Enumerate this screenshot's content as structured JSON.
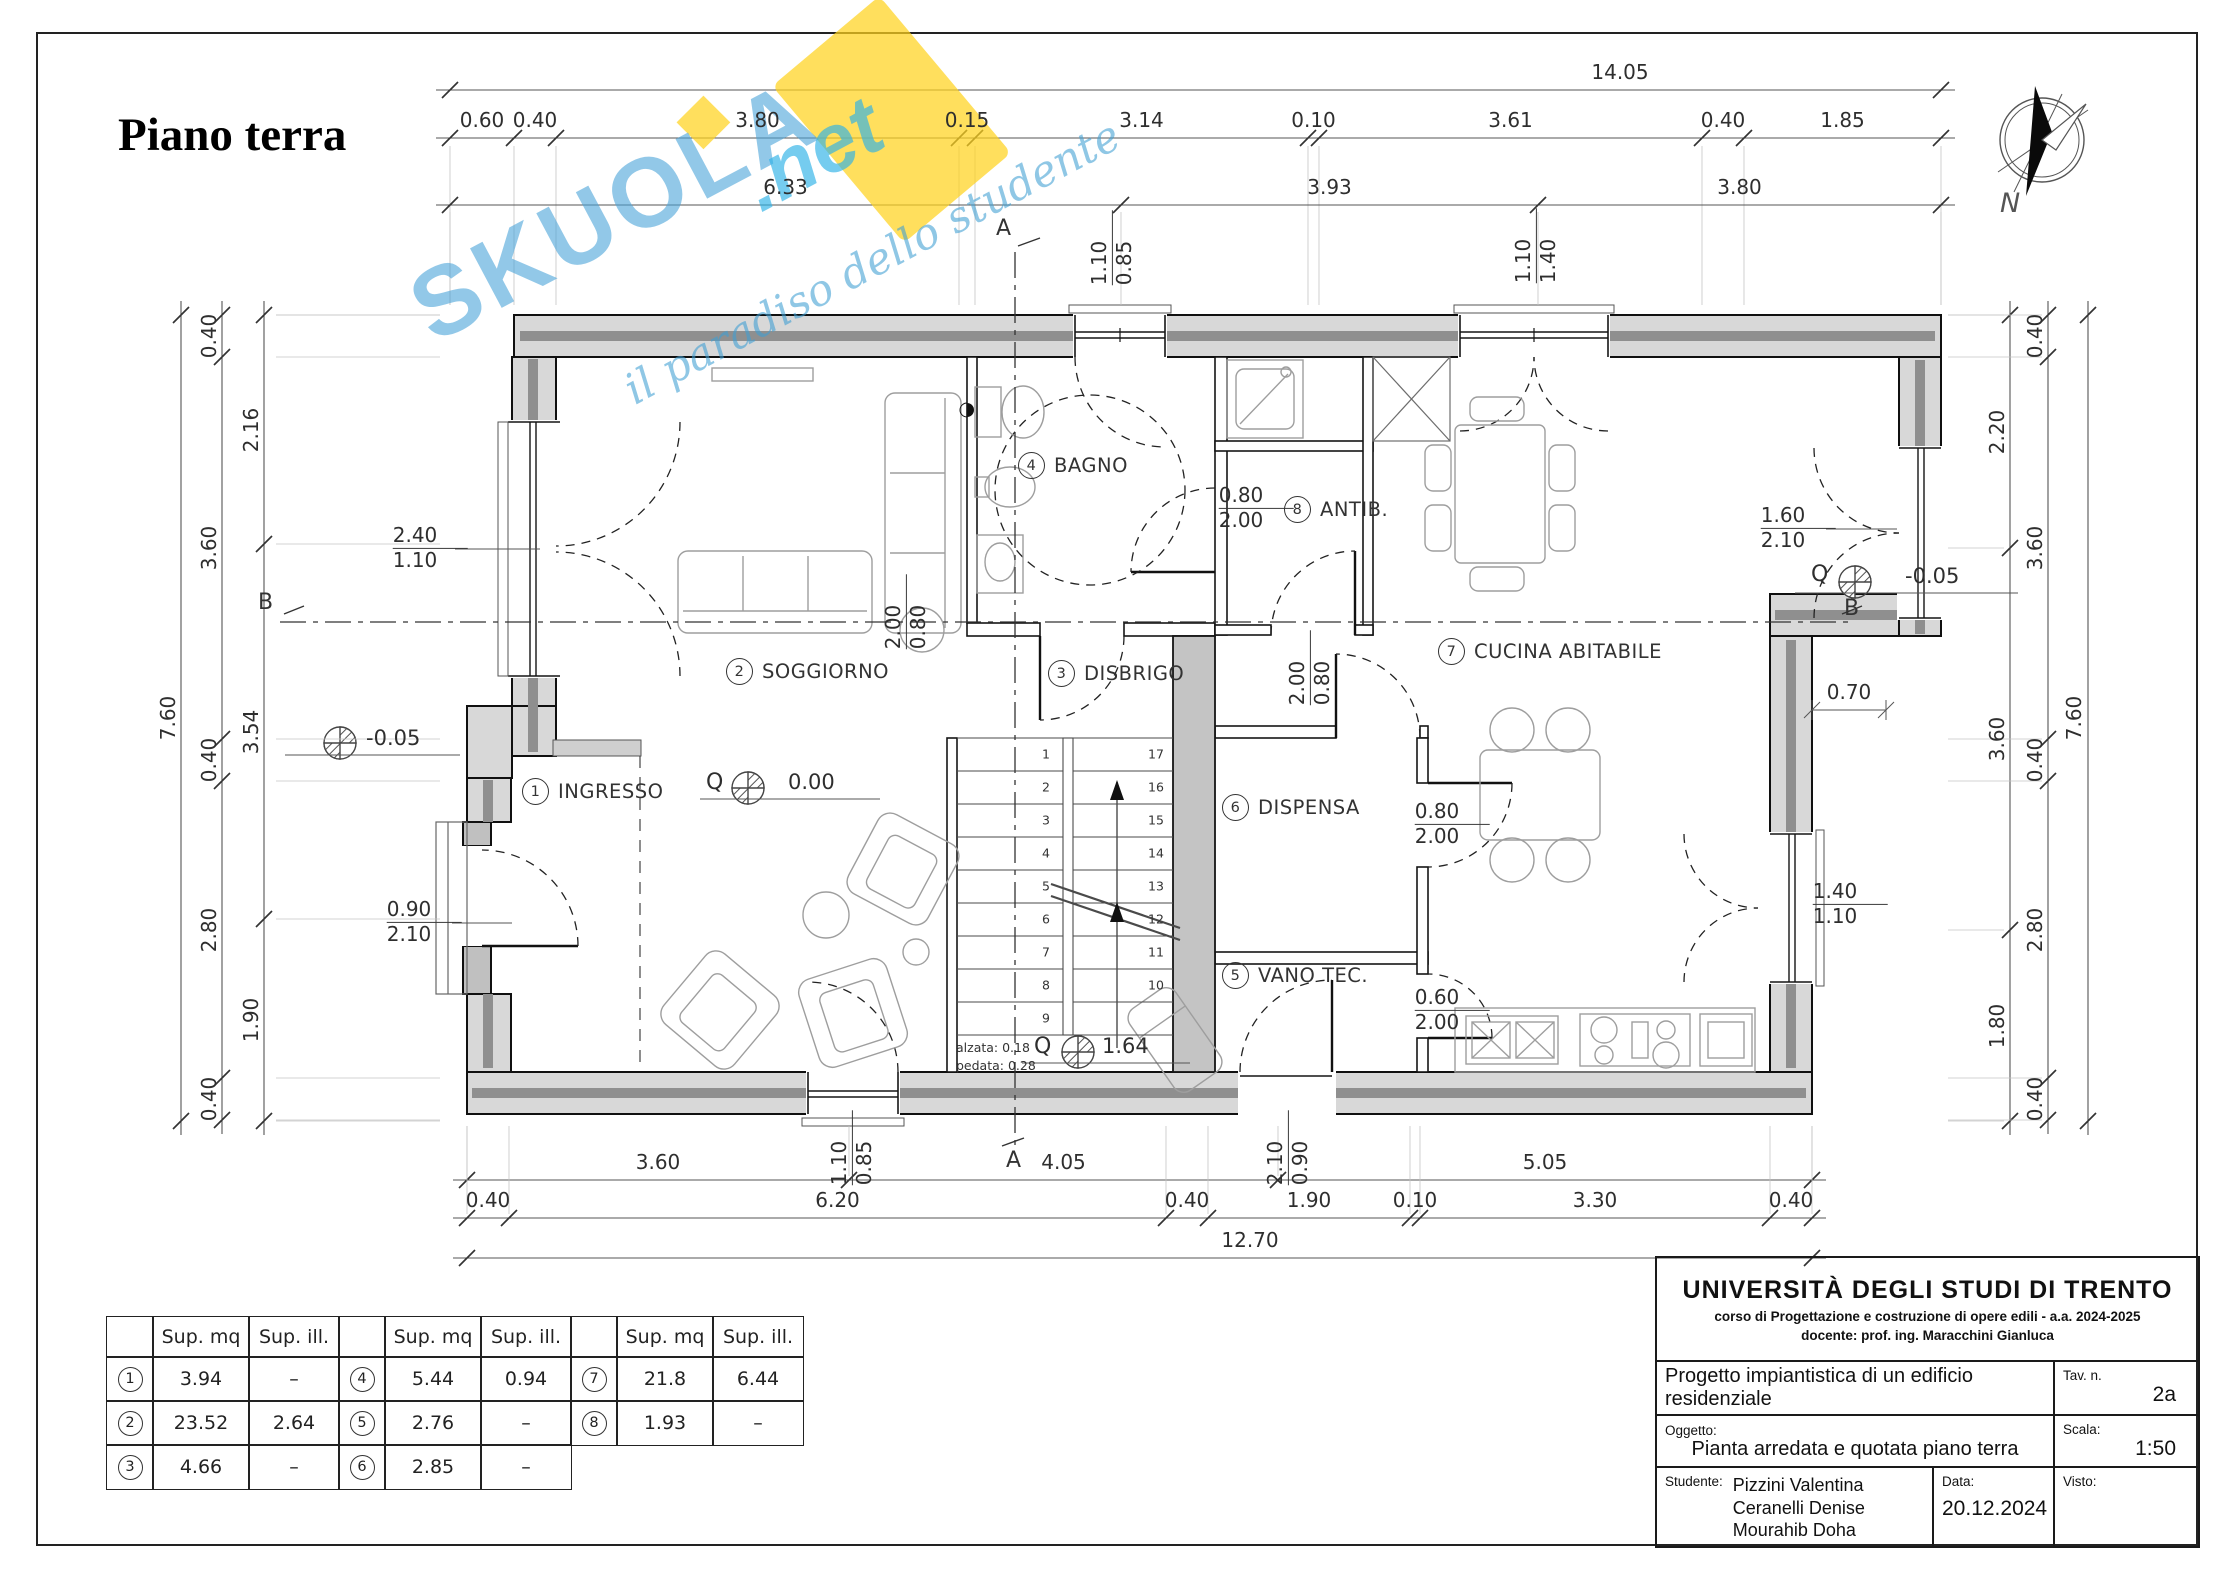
{
  "sheet": {
    "title": "Piano terra",
    "compass": "N"
  },
  "watermark": {
    "brand": "SKUOLA",
    "suffix": ".net",
    "tagline": "il paradiso dello studente"
  },
  "sections": {
    "a": "A",
    "b": "B"
  },
  "quotas": {
    "prefix": "Q",
    "left": "-0.05",
    "living": "0.00",
    "right": "-0.05"
  },
  "stairs": {
    "left_steps": [
      "1",
      "2",
      "3",
      "4",
      "5",
      "6",
      "7",
      "8",
      "9"
    ],
    "right_steps": [
      "17",
      "16",
      "15",
      "14",
      "13",
      "12",
      "11",
      "10"
    ],
    "riser_note": "alzata: 0.18",
    "tread_note": "pedata: 0.28",
    "quota_prefix": "Q",
    "mid_quota": "1.64"
  },
  "rooms": [
    {
      "num": "1",
      "name": "INGRESSO"
    },
    {
      "num": "2",
      "name": "SOGGIORNO"
    },
    {
      "num": "3",
      "name": "DISBRIGO"
    },
    {
      "num": "4",
      "name": "BAGNO"
    },
    {
      "num": "5",
      "name": "VANO  TEC."
    },
    {
      "num": "6",
      "name": "DISPENSA"
    },
    {
      "num": "7",
      "name": "CUCINA  ABITABILE"
    },
    {
      "num": "8",
      "name": "ANTIB."
    }
  ],
  "openings": {
    "left_window": [
      "2.40",
      "1.10"
    ],
    "entry_door": [
      "0.90",
      "2.10"
    ],
    "bath_window": [
      "0.85",
      "1.10"
    ],
    "dining_window": [
      "1.40",
      "1.10"
    ],
    "terrace_door": [
      "1.60",
      "2.10"
    ],
    "kitchen_window": [
      "1.40",
      "1.10"
    ],
    "rear_window": [
      "0.85",
      "1.10"
    ],
    "rear_door": [
      "0.90",
      "2.10"
    ],
    "bath_hall_door": [
      "0.80",
      "2.00"
    ],
    "bath_antib_door": [
      "0.80",
      "2.00"
    ],
    "antib_hall_door": [
      "0.80",
      "2.00"
    ],
    "pantry_door": [
      "0.80",
      "2.00"
    ],
    "tech_door": [
      "0.60",
      "2.00"
    ],
    "wall_recess": "0.70"
  },
  "dims": {
    "top": {
      "row1": "14.05",
      "row2": [
        "0.60",
        "0.40",
        "3.80",
        "0.15",
        "3.14",
        "0.10",
        "3.61",
        "0.40",
        "1.85"
      ],
      "row3": [
        "6.33",
        "3.93",
        "3.80"
      ]
    },
    "bottom": {
      "row1": [
        "3.60",
        "4.05",
        "5.05"
      ],
      "row2": [
        "0.40",
        "6.20",
        "0.40",
        "1.90",
        "0.10",
        "3.30",
        "0.40"
      ],
      "row3": "12.70"
    },
    "left": {
      "overall": "7.60",
      "mid": [
        "0.40",
        "3.60",
        "0.40",
        "2.80",
        "0.40"
      ],
      "inner": [
        "2.16",
        "3.54",
        "1.90"
      ]
    },
    "right": {
      "overall": "7.60",
      "mid": [
        "0.40",
        "3.60",
        "0.40",
        "2.80",
        "0.40"
      ],
      "inner": [
        "2.20",
        "3.60",
        "1.80"
      ]
    }
  },
  "area_table": {
    "headers": [
      "Sup. mq",
      "Sup. ill."
    ],
    "groups": [
      [
        {
          "num": "1",
          "mq": "3.94",
          "ill": "–"
        },
        {
          "num": "2",
          "mq": "23.52",
          "ill": "2.64"
        },
        {
          "num": "3",
          "mq": "4.66",
          "ill": "–"
        }
      ],
      [
        {
          "num": "4",
          "mq": "5.44",
          "ill": "0.94"
        },
        {
          "num": "5",
          "mq": "2.76",
          "ill": "–"
        },
        {
          "num": "6",
          "mq": "2.85",
          "ill": "–"
        }
      ],
      [
        {
          "num": "7",
          "mq": "21.8",
          "ill": "6.44"
        },
        {
          "num": "8",
          "mq": "1.93",
          "ill": "–"
        }
      ]
    ]
  },
  "title_block": {
    "university": "UNIVERSITÀ  DEGLI STUDI DI TRENTO",
    "course": "corso di Progettazione e costruzione di opere edili - a.a. 2024-2025",
    "teacher": "docente: prof. ing. Maracchini Gianluca",
    "project": "Progetto impiantistica di un edificio residenziale",
    "tav_label": "Tav. n.",
    "tav": "2a",
    "object_label": "Oggetto:",
    "object": "Pianta arredata e quotata piano terra",
    "scale_label": "Scala:",
    "scale": "1:50",
    "student_label": "Studente:",
    "students": [
      "Pizzini Valentina",
      "Ceranelli Denise",
      "Mourahib Doha"
    ],
    "date_label": "Data:",
    "date": "20.12.2024",
    "visto_label": "Visto:"
  }
}
